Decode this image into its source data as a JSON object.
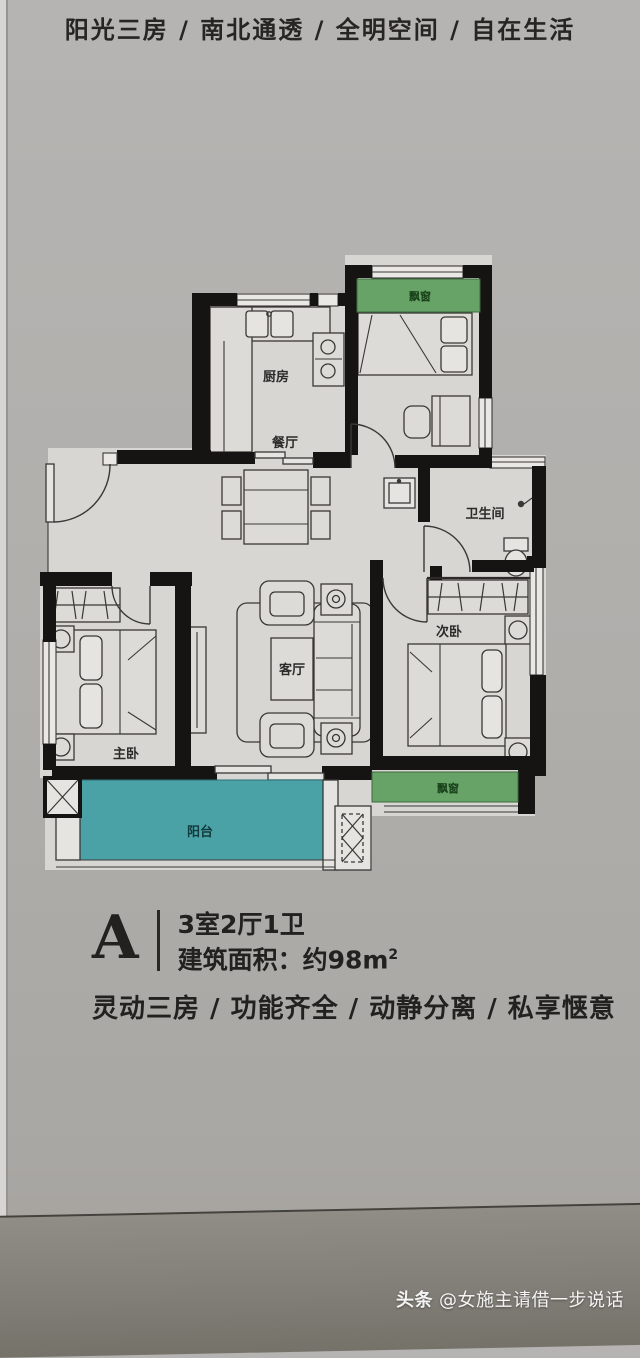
{
  "headline": {
    "top": "阳光三房 / 南北通透 / 全明空间 / 自在生活",
    "bottom_slogan": "灵动三房 / 功能齐全 / 动静分离 / 私享惬意"
  },
  "unit": {
    "label": "A",
    "layout": "3室2厅1卫",
    "area_prefix": "建筑面积：约98m",
    "area_sup": "2"
  },
  "plan": {
    "rooms": {
      "kitchen": "厨房",
      "dining": "餐厅",
      "living": "客厅",
      "master_bedroom": "主卧",
      "second_bedroom": "次卧",
      "bathroom": "卫生间",
      "balcony": "阳台",
      "bay_window": "飘窗"
    }
  },
  "watermark": {
    "brand": "头条",
    "handle": "@女施主请借一步说话"
  },
  "colors": {
    "page_background": "#b1afac",
    "plan_floor": "#d8d6d2",
    "wall": "#161412",
    "balcony_fill": "#4aa2a7",
    "bay_window_fill": "#67a267",
    "bay_window_text": "#173f18",
    "balcony_text": "#123a3c",
    "fold_shadow": "#827f79",
    "watermark_text": "#ffffff"
  }
}
